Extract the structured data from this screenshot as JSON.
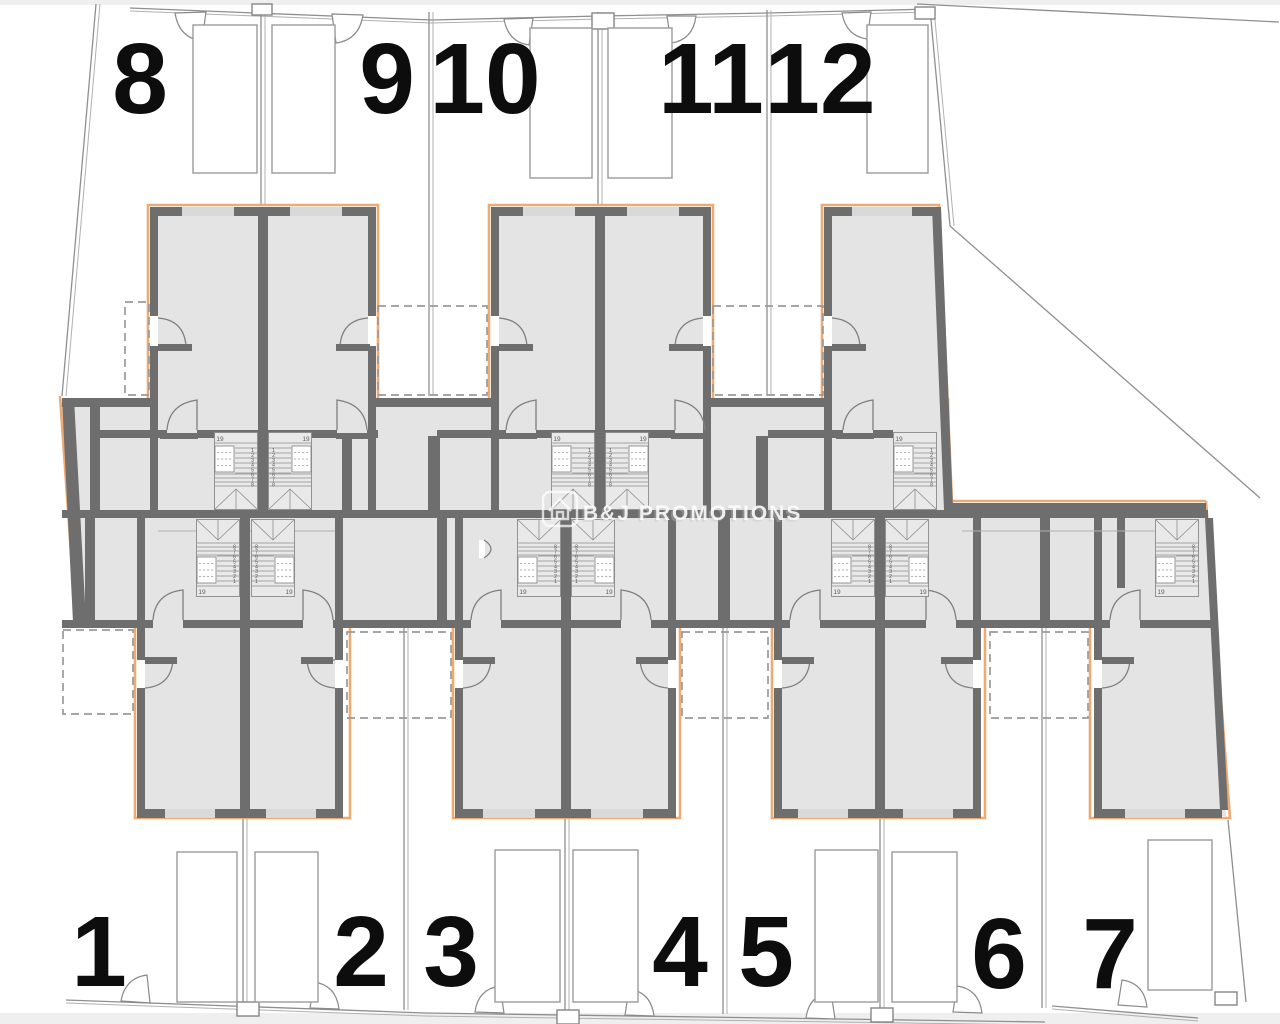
{
  "colors": {
    "background": "#ffffff",
    "edge_strip": "#efefef",
    "wall": "#6e6e6e",
    "floor": "#e4e4e4",
    "accent_orange": "#edaa72",
    "boundary_line": "#8f8f8f",
    "dashed_line": "#9a9a9a",
    "plot_number": "#0d0d0d",
    "watermark": "#ffffff"
  },
  "watermark": {
    "text": "B&J PROMOTIONS",
    "icon": "house-badge-icon"
  },
  "plot_numbers": [
    {
      "label": "8",
      "x": 140,
      "y": 113
    },
    {
      "label": "9",
      "x": 387,
      "y": 113
    },
    {
      "label": "10",
      "x": 485,
      "y": 113
    },
    {
      "label": "11",
      "x": 711,
      "y": 113
    },
    {
      "label": "12",
      "x": 820,
      "y": 113
    },
    {
      "label": "1",
      "x": 99,
      "y": 986
    },
    {
      "label": "2",
      "x": 361,
      "y": 986
    },
    {
      "label": "3",
      "x": 451,
      "y": 986
    },
    {
      "label": "4",
      "x": 680,
      "y": 986
    },
    {
      "label": "5",
      "x": 766,
      "y": 986
    },
    {
      "label": "6",
      "x": 999,
      "y": 988
    },
    {
      "label": "7",
      "x": 1110,
      "y": 988
    }
  ],
  "parking_spaces": [
    {
      "x": 193,
      "y": 25,
      "w": 64,
      "h": 148
    },
    {
      "x": 272,
      "y": 25,
      "w": 63,
      "h": 148
    },
    {
      "x": 530,
      "y": 28,
      "w": 62,
      "h": 150
    },
    {
      "x": 608,
      "y": 28,
      "w": 64,
      "h": 150
    },
    {
      "x": 867,
      "y": 25,
      "w": 61,
      "h": 148
    },
    {
      "x": 177,
      "y": 852,
      "w": 60,
      "h": 150
    },
    {
      "x": 255,
      "y": 852,
      "w": 63,
      "h": 150
    },
    {
      "x": 495,
      "y": 850,
      "w": 65,
      "h": 152
    },
    {
      "x": 573,
      "y": 850,
      "w": 65,
      "h": 152
    },
    {
      "x": 815,
      "y": 850,
      "w": 63,
      "h": 152
    },
    {
      "x": 892,
      "y": 852,
      "w": 65,
      "h": 150
    },
    {
      "x": 1148,
      "y": 840,
      "w": 64,
      "h": 150
    }
  ],
  "stairs": {
    "step_labels": [
      "1",
      "2",
      "3",
      "4",
      "5",
      "6",
      "7",
      "8"
    ],
    "landing_label": "19",
    "wells": [
      {
        "x": 214,
        "y": 432,
        "mx": 0,
        "fy": 0
      },
      {
        "x": 268,
        "y": 432,
        "mx": 1,
        "fy": 0
      },
      {
        "x": 551,
        "y": 432,
        "mx": 0,
        "fy": 0
      },
      {
        "x": 605,
        "y": 432,
        "mx": 1,
        "fy": 0
      },
      {
        "x": 893,
        "y": 432,
        "mx": 0,
        "fy": 0
      },
      {
        "x": 196,
        "y": 519,
        "mx": 0,
        "fy": 1
      },
      {
        "x": 251,
        "y": 519,
        "mx": 1,
        "fy": 1
      },
      {
        "x": 517,
        "y": 519,
        "mx": 0,
        "fy": 1
      },
      {
        "x": 571,
        "y": 519,
        "mx": 1,
        "fy": 1
      },
      {
        "x": 831,
        "y": 519,
        "mx": 0,
        "fy": 1
      },
      {
        "x": 885,
        "y": 519,
        "mx": 1,
        "fy": 1
      },
      {
        "x": 1155,
        "y": 519,
        "mx": 0,
        "fy": 1
      }
    ]
  }
}
